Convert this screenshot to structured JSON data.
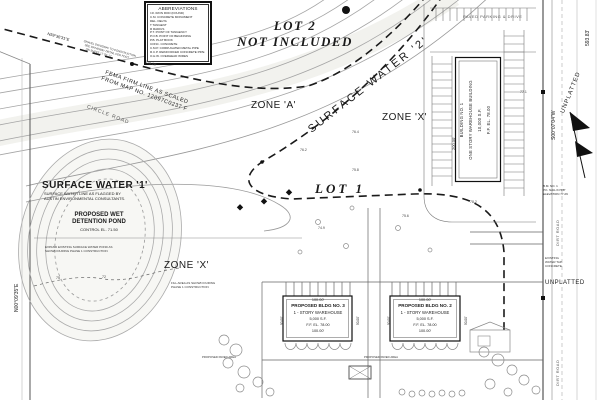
{
  "legend": {
    "title": "ABBREVIATIONS",
    "rows": [
      "I.R.   IRON ROD (FOUND)",
      "C.M.   CONCRETE MONUMENT",
      "DEL.   DELTA",
      "T      TANGENT",
      "R      RADIUS",
      "P.T.   POINT OF TANGENCY",
      "P.O.B. POINT OF BEGINNING",
      "P.B.   PLAT BOOK",
      "CONC.  CONCRETE",
      "C.M.P. CORRUGATED METAL PIPE",
      "R.C.P. REINFORCED CONCRETE PIPE",
      "O.H.W. OVERHEAD WIRES"
    ]
  },
  "labels": {
    "lot2_line1": "LOT 2",
    "lot2_line2": "NOT INCLUDED",
    "surface_water_2": "SURFACE WATER '2'",
    "zone_a": "ZONE 'A'",
    "zone_x_right": "ZONE 'X'",
    "zone_x_left": "ZONE 'X'",
    "lot1": "LOT 1",
    "unplatted": "UNPLATTED"
  },
  "surface_water_1": {
    "title": "SURFACE WATER '1'",
    "note1": "SURFACE WATER LINE AS FLAGGED BY",
    "note2": "AUSTIN ENVIRONMENTAL CONSULTANTS.",
    "pond1": "PROPOSED WET",
    "pond2": "DETENTION POND",
    "control": "CONTROL EL. 71.50"
  },
  "notes": {
    "pond1": "EXPAND EXISTING SURFACE WATER POND AS",
    "pond2": "SHOWN DURING PHASE 1 CONSTRUCTION",
    "fill1": "FILL AREA AS SHOWN DURING",
    "fill2": "PHASE 1 CONSTRUCTION",
    "nw1": "GRAVEL DRIVEWAY TO CONSTRUCTION",
    "nw2": "SEE DRIVEWAY DETAIL PER FDOT",
    "nw3": "ON SHEET 17 OF 17",
    "tap1": "EXISTING",
    "tap2": "WATER TAP",
    "tap3": "CONCRETE"
  },
  "fema": {
    "line1": "FEMA FIRM LINE AS SCALED",
    "line2": "FROM MAP NO. 12097C0237 F",
    "dim": "320.16'"
  },
  "roads": {
    "circle_road": "CIRCLE ROAD",
    "dirt_road_1": "DIRT ROAD",
    "dirt_road_2": "DIRT ROAD",
    "paved_parking": "PAVED PARKING & DRIVE"
  },
  "bearings": {
    "west": "N00°09'35\"E",
    "east": "S00°07'04\"W",
    "northwest": "N59°36'31\"E",
    "east_dist": "593.83'"
  },
  "benchmark": {
    "l1": "B.M. NO. 1",
    "l2": "P.K. NAIL IN 5/8\"",
    "l3": "ELEVATION 77.29"
  },
  "buildings": {
    "b1": {
      "dim": "200.00'",
      "l1": "BUILDING NO. 1",
      "l2": "ONE STORY WAREHOUSE BUILDING",
      "l3": "10,000 S.F.",
      "l4": "F.F. EL. 78.00"
    },
    "b3": {
      "top": "100.00'",
      "l1": "PROPOSED BLDG NO. 3",
      "l2": "1 - STORY WAREHOUSE",
      "l3": "5,000 S.F.",
      "l4": "F.F. EL. 78.00",
      "bottom": "100.00'",
      "side": "50.00'"
    },
    "b2": {
      "top": "100.00'",
      "l1": "PROPOSED BLDG NO. 2",
      "l2": "1 - STORY WAREHOUSE",
      "l3": "5,000 S.F.",
      "l4": "F.F. EL. 78.00",
      "bottom": "100.00'",
      "side": "50.00'"
    }
  },
  "paved_area": "PROPOSED PAVED AREA",
  "spots": [
    {
      "t": "75"
    },
    {
      "t": "72"
    },
    {
      "t": "76.2"
    },
    {
      "t": "75.8"
    },
    {
      "t": "74.9"
    },
    {
      "t": "75.6"
    },
    {
      "t": "76.4"
    },
    {
      "t": "77.1"
    },
    {
      "t": "78.2"
    }
  ]
}
